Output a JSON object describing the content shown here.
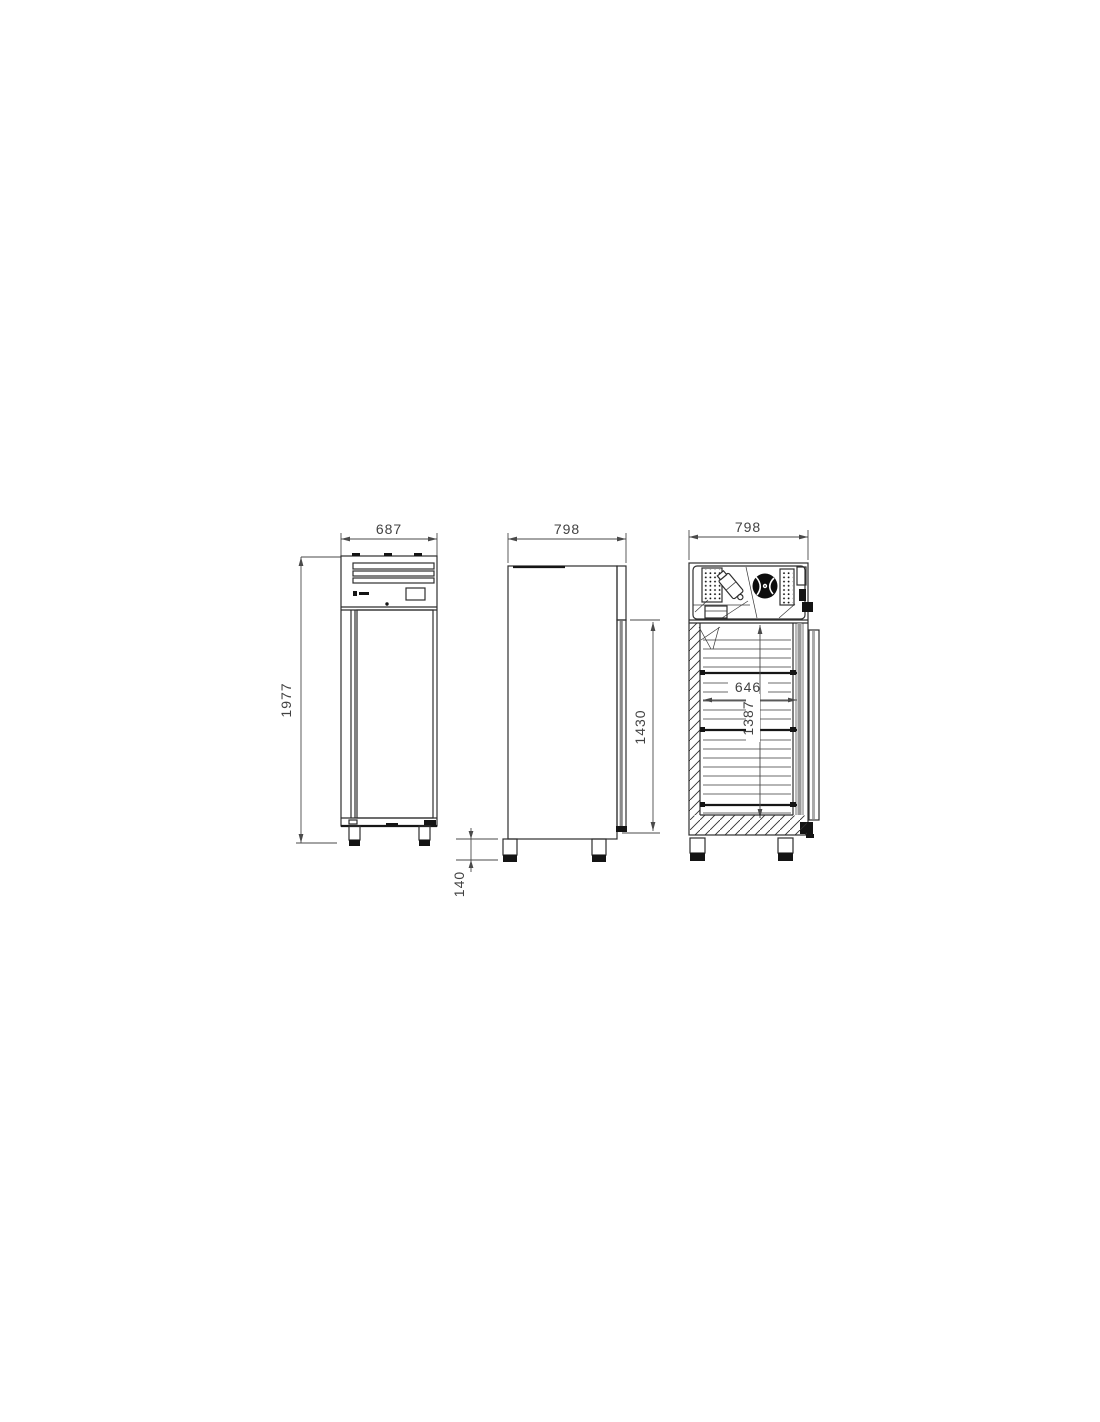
{
  "colors": {
    "background": "#ffffff",
    "line": "#2e2e2e",
    "dimension_text": "#424242",
    "dark_fill": "#141414"
  },
  "dimensions": {
    "front": {
      "width": "687",
      "height": "1977"
    },
    "side": {
      "depth": "798",
      "door_height": "1430",
      "feet_height": "140"
    },
    "section": {
      "depth": "798",
      "interior_width": "646",
      "interior_height": "1387"
    }
  }
}
